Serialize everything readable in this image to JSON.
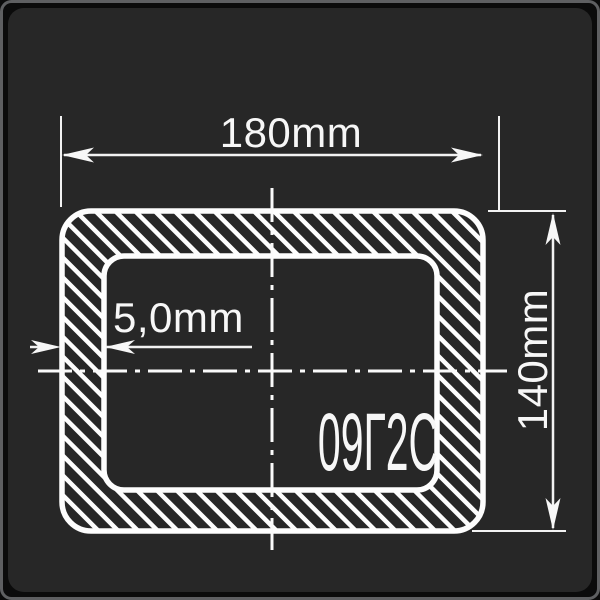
{
  "diagram": {
    "kind": "rectangular-steel-tube-cross-section",
    "dimensions": {
      "width_label": "180mm",
      "height_label": "140mm",
      "wall_thickness_label": "5,0mm"
    },
    "material_label": "09Г2С",
    "colors": {
      "panel_background": "#272727",
      "outer_frame": "#0b0b0b",
      "frame_border": "#5e5f61",
      "line_color": "#fdfdfd",
      "text_color": "#f7f7f7"
    }
  }
}
